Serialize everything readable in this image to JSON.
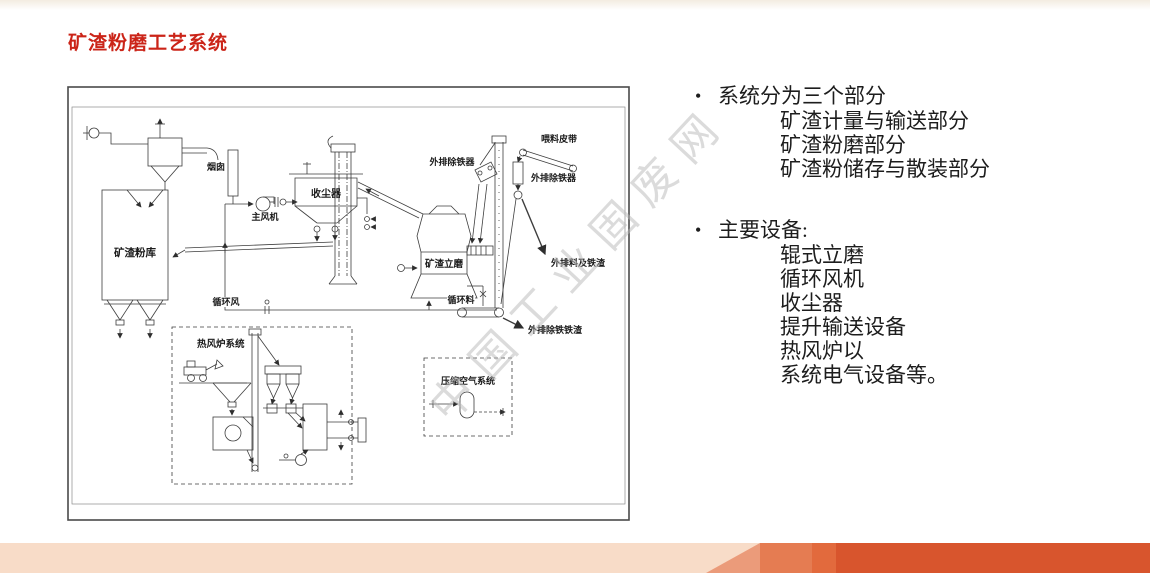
{
  "slide": {
    "title": "矿渣粉磨工艺系统",
    "title_color": "#cb2418",
    "watermark": "中国工业固废网",
    "bullets": [
      {
        "label": "系统分为三个部分",
        "sub_items": [
          "矿渣计量与输送部分",
          "矿渣粉磨部分",
          "矿渣粉储存与散装部分"
        ]
      },
      {
        "label": "主要设备:",
        "sub_items": [
          "辊式立磨",
          "循环风机",
          "收尘器",
          "提升输送设备",
          "热风炉以",
          "系统电气设备等。"
        ]
      }
    ]
  },
  "diagram": {
    "labels": {
      "silo": "矿渣粉库",
      "chimney": "烟囱",
      "main_fan": "主风机",
      "dust_collector": "收尘器",
      "iron_remover_left": "外排除铁器",
      "iron_remover_right": "外排除铁器",
      "feed_belt": "喂料皮带",
      "discharge_iron_slag": "外排料及铁渣",
      "vertical_mill": "矿渣立磨",
      "circulating_air": "循环风",
      "circulating_material": "循环料",
      "external_iron_slag": "外排除铁铁渣",
      "hot_air_furnace_system": "热风炉系统",
      "compressed_air_system": "压缩空气系统"
    }
  },
  "footer_colors": {
    "base": "#f8dcc8",
    "triangle": "#eb9b7a",
    "band1": "#e57c52",
    "band2": "#e26a3d",
    "main": "#d8552d"
  }
}
